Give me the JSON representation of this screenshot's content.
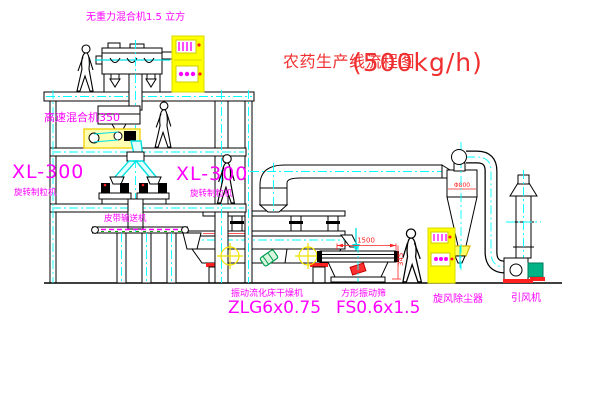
{
  "title": {
    "text": "农药生产线流程图",
    "capacity": "(500kg/h)"
  },
  "labels": {
    "gravity_mixer": "无重力混合机1.5 立方",
    "high_speed_mixer": "高速混合机350",
    "granulator_left_model": "XL-300",
    "granulator_left_name": "旋转制粒机",
    "granulator_mid_model": "XL-300",
    "granulator_mid_name": "旋转制粒机",
    "belt_conveyor": "皮带输送机",
    "dryer_name": "振动流化床干燥机",
    "dryer_model": "ZLG6x0.75",
    "screen_name": "方形振动筛",
    "screen_model": "FS0.6x1.5",
    "cyclone": "旋风除尘器",
    "fan": "引风机"
  },
  "dimensions": {
    "screen_length": "1500",
    "screen_height": "345",
    "cyclone_diameter": "Φ800"
  },
  "colors": {
    "label_magenta": "#ff00ff",
    "title_red": "#f03030",
    "centerline_cyan": "#00ffff",
    "cabinet_yellow": "#ffff00",
    "motor_green": "#00b386",
    "dimension_red": "#ff2020"
  }
}
